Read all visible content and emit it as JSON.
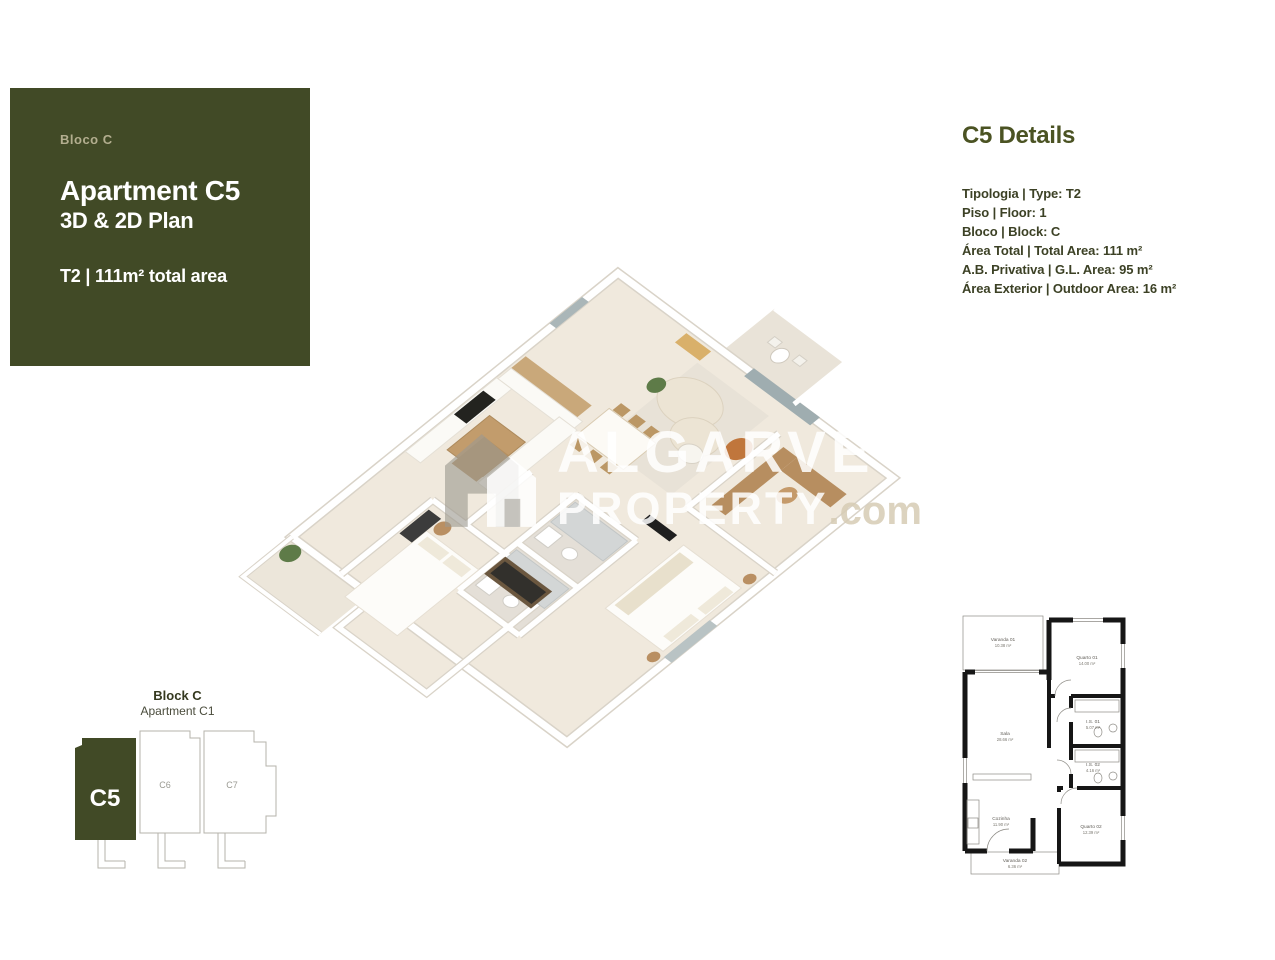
{
  "info_card": {
    "block_label": "Bloco C",
    "title": "Apartment C5",
    "subtitle": "3D & 2D Plan",
    "type_area": "T2 | 111m² total area"
  },
  "details_panel": {
    "heading": "C5 Details",
    "rows": [
      "Tipologia | Type: T2",
      "Piso | Floor: 1",
      "Bloco | Block: C",
      "Área Total | Total Area: 111 m²",
      "A.B. Privativa | G.L. Area: 95 m²",
      "Área Exterior | Outdoor Area: 16 m²"
    ]
  },
  "watermark": {
    "word1": "ALGARVE",
    "word2": "PROPERTY",
    "word2_suffix": ".com"
  },
  "block_locator": {
    "title": "Block C",
    "subtitle": "Apartment C1",
    "units": [
      {
        "id": "C5",
        "highlighted": true
      },
      {
        "id": "C6",
        "highlighted": false
      },
      {
        "id": "C7",
        "highlighted": false
      }
    ]
  },
  "plan_2d": {
    "rooms": [
      {
        "name": "Varanda 01",
        "area": "10.38 m²"
      },
      {
        "name": "Quarto 01",
        "area": "14.00 m²"
      },
      {
        "name": "Sala",
        "area": "28.66 m²"
      },
      {
        "name": "I.S. 01",
        "area": "5.07 m²"
      },
      {
        "name": "I.S. 02",
        "area": "4.16 m²"
      },
      {
        "name": "Cozinha",
        "area": "11.90 m²"
      },
      {
        "name": "Quarto 02",
        "area": "12.39 m²"
      },
      {
        "name": "Varanda 02",
        "area": "6.36 m²"
      }
    ]
  },
  "colors": {
    "brand_green": "#414a26",
    "heading_green": "#4b5323",
    "text_dark": "#3c4125",
    "muted_tan": "#b3ae8f",
    "wall_black": "#161616",
    "floor_cream": "#f0e9dd",
    "wood": "#c6a376",
    "accent_orange": "#c0763c"
  }
}
